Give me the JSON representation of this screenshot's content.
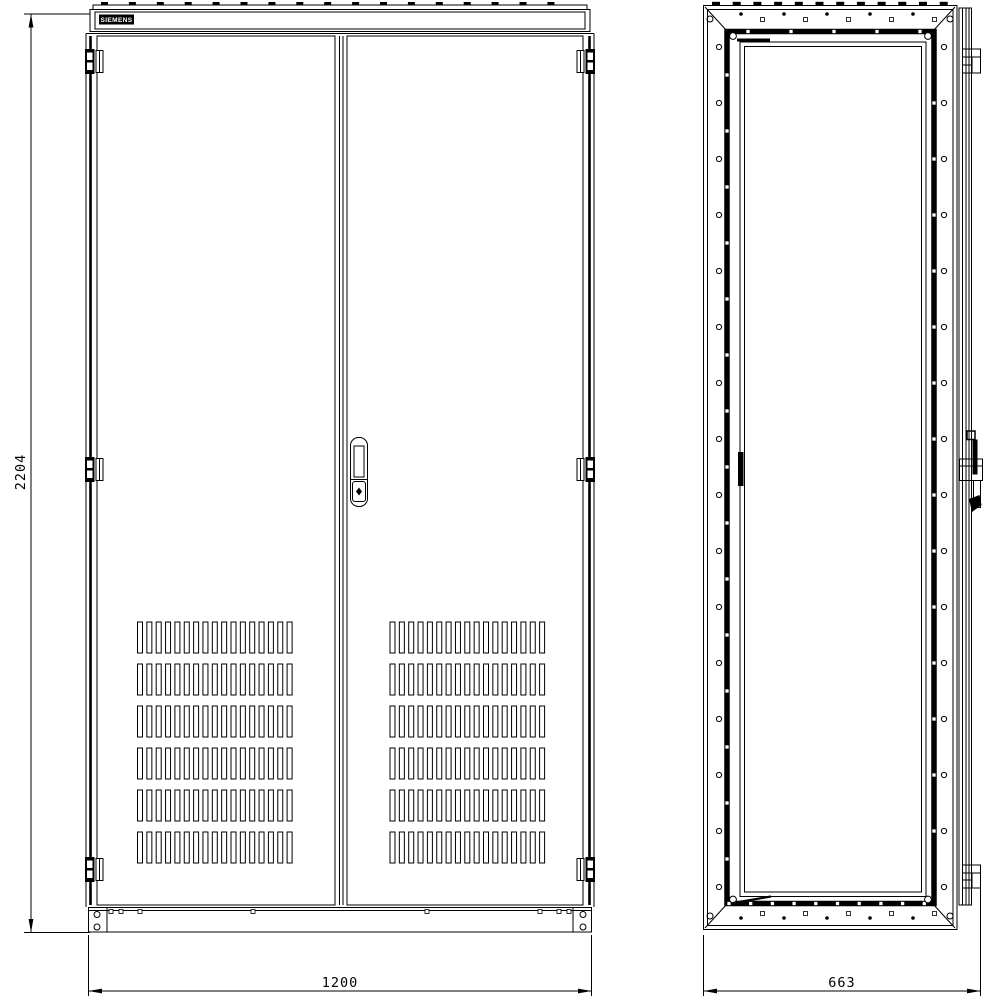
{
  "brand_label": "SIEMENS",
  "dimensions": {
    "height": "2204",
    "width": "1200",
    "depth": "663"
  }
}
